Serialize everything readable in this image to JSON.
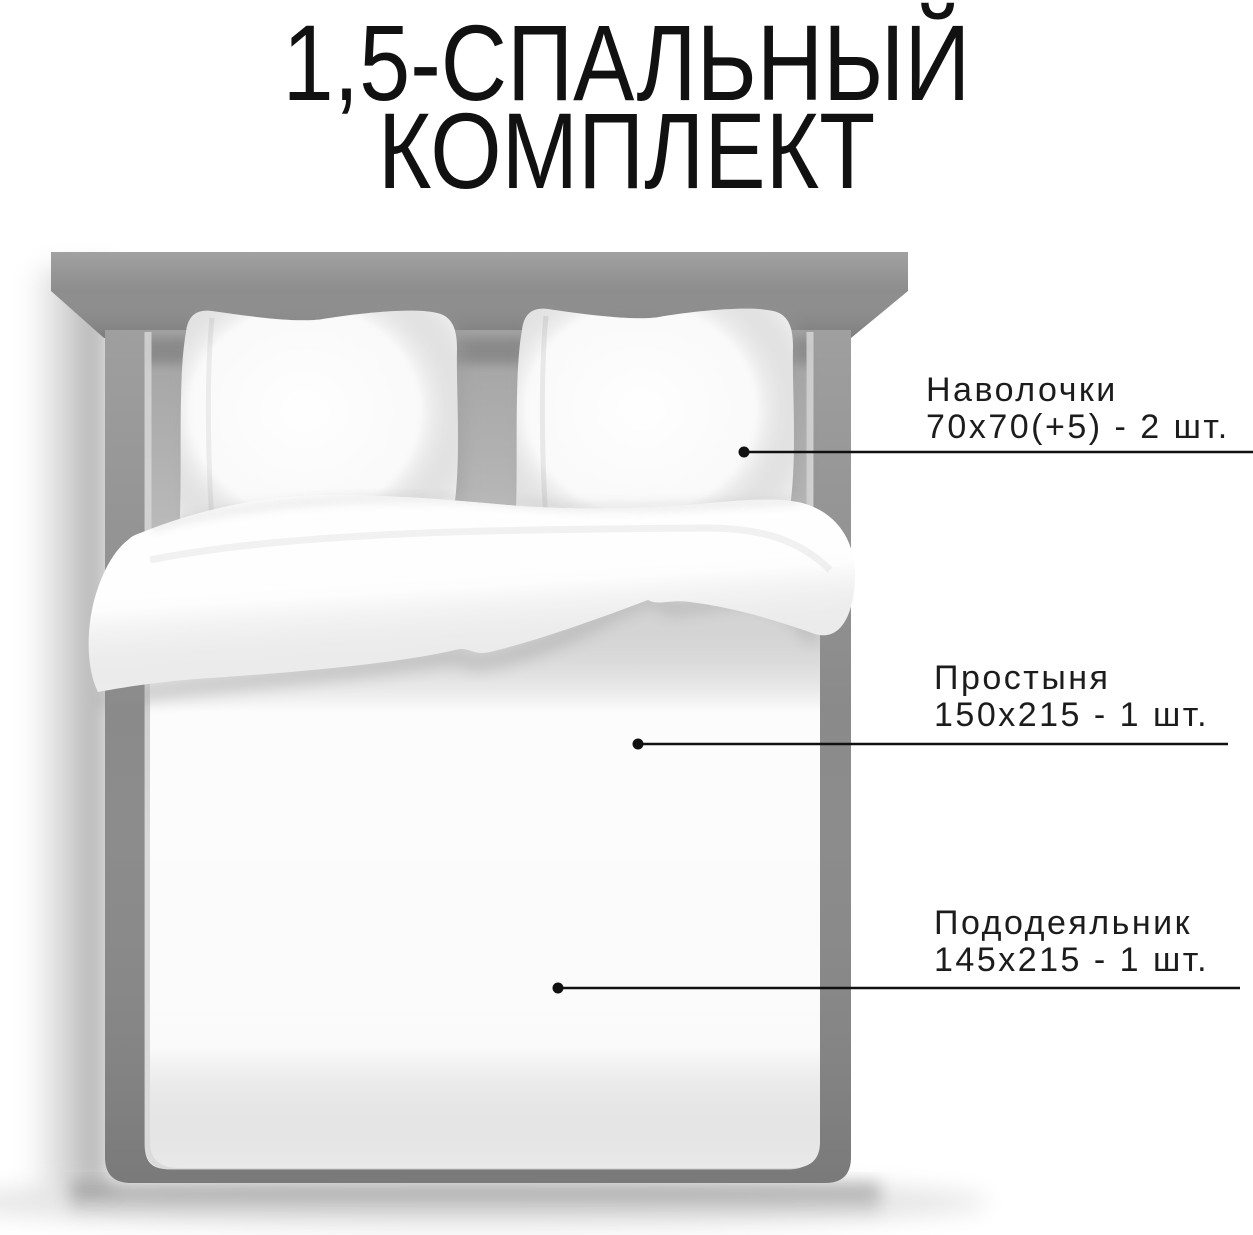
{
  "title": {
    "line1": "1,5-СПАЛЬНЫЙ",
    "line2": "КОМПЛЕКТ"
  },
  "callouts": [
    {
      "label": "Наволочки",
      "size": "70х70(+5) - 2 шт."
    },
    {
      "label": "Простыня",
      "size": "150х215 - 1 шт."
    },
    {
      "label": "Пододеяльник",
      "size": "145х215 - 1 шт."
    }
  ],
  "colors": {
    "background": "#ffffff",
    "text": "#1c1c1c",
    "leader_line": "#111111",
    "headboard": "#8d8d8d",
    "bed_frame": "#8a8a8a",
    "frame_highlight": "#d6d6d6",
    "mattress": "#c6c6c6",
    "pillow": "#f7f7f7",
    "duvet": "#f9f9f9",
    "sheet_flap": "#fdfdfd"
  }
}
